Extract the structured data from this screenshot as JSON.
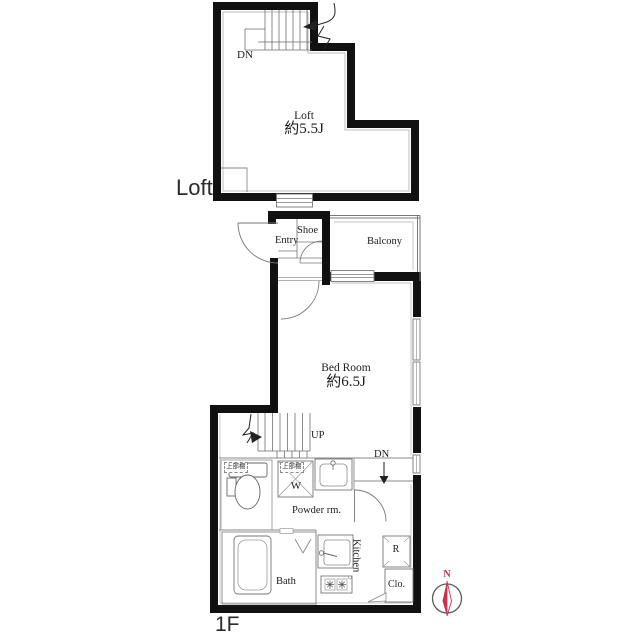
{
  "floor_labels": {
    "loft": "Loft",
    "first": "1F"
  },
  "loft": {
    "room_name": "Loft",
    "room_area": "約5.5J",
    "stairs_down": "DN"
  },
  "first_floor": {
    "entry": "Entry",
    "shoe": "Shoe",
    "balcony": "Balcony",
    "bedroom_name": "Bed Room",
    "bedroom_area": "約6.5J",
    "stairs_up": "UP",
    "stairs_down": "DN",
    "toilet_shelf": "上部棚",
    "washer_shelf": "上部棚",
    "washer": "W",
    "powder_room": "Powder rm.",
    "bath": "Bath",
    "kitchen": "Kitchen",
    "fridge": "R",
    "closet": "Clo."
  },
  "compass": {
    "north": "N"
  },
  "colors": {
    "wall": "#111111",
    "thin_line": "#6f6f6f",
    "light_line": "#bbbbbb",
    "compass_red": "#c9334e"
  }
}
